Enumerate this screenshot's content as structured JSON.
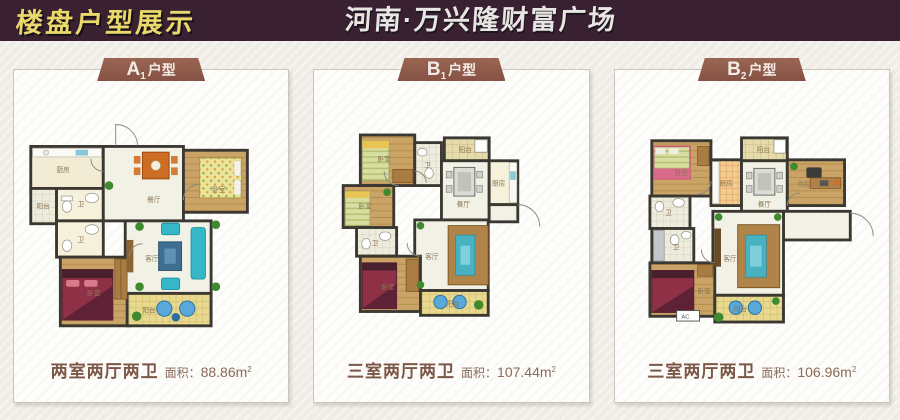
{
  "header": {
    "site_title": "楼盘户型展示",
    "project_title": "河南·万兴隆财富广场"
  },
  "room_labels": {
    "bedroom": "卧室",
    "living": "客厅",
    "dining": "餐厅",
    "kitchen": "厨房",
    "bath": "卫",
    "balcony": "阳台",
    "study": "书房",
    "ac": "AC"
  },
  "plans": [
    {
      "tab": "A",
      "tab_sub": "1",
      "tab_suffix": "户型",
      "spec": "两室两厅两卫",
      "area_label": "面积：",
      "area_value": "88.86m",
      "area_sup": "2"
    },
    {
      "tab": "B",
      "tab_sub": "1",
      "tab_suffix": "户型",
      "spec": "三室两厅两卫",
      "area_label": "面积：",
      "area_value": "107.44m",
      "area_sup": "2"
    },
    {
      "tab": "B",
      "tab_sub": "2",
      "tab_suffix": "户型",
      "spec": "三室两厅两卫",
      "area_label": "面积：",
      "area_value": "106.96m",
      "area_sup": "2"
    }
  ],
  "colors": {
    "header_bg": "#392132",
    "title_yellow": "#e9d86a",
    "title_white": "#e8e6e2",
    "ribbon_brown": "#8e5a4a",
    "caption_brown": "#7c5646",
    "area_brown": "#8a6a58",
    "page_bg": "#f0ede6",
    "card_bg": "#fdfdfb",
    "card_border": "#cbc5bd",
    "wall": "#3b3831",
    "wood_floor": "#c9a466",
    "living_floor": "#f1f2e5",
    "balcony_floor": "#e8d98e",
    "sofa_teal": "#35b7c8",
    "sofa_brown": "#b08448",
    "bed_red": "#8e3147"
  }
}
